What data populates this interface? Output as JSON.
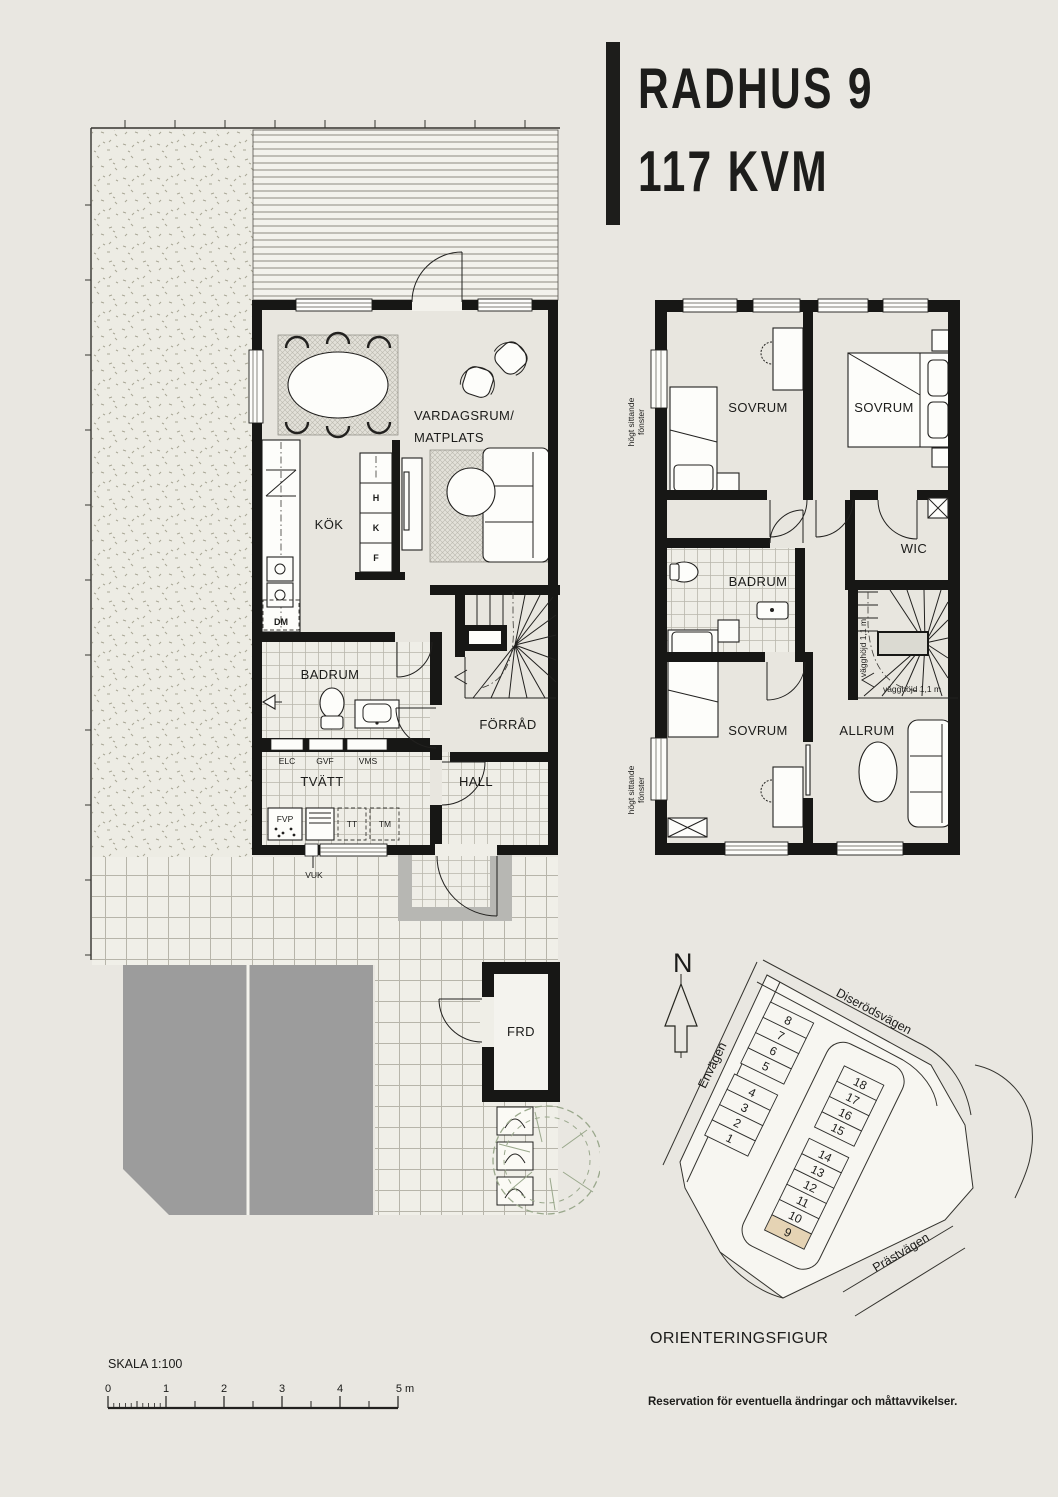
{
  "title": {
    "line1": "RADHUS 9",
    "line2": "117 KVM"
  },
  "ground_floor": {
    "living_room_line1": "VARDAGSRUM/",
    "living_room_line2": "MATPLATS",
    "kitchen": "KÖK",
    "bathroom": "BADRUM",
    "storage": "FÖRRÅD",
    "laundry": "TVÄTT",
    "hall": "HALL",
    "outdoor_storage": "FRD",
    "dishwasher": "DM",
    "cabinet_h": "H",
    "cabinet_k": "K",
    "cabinet_f": "F",
    "elc": "ELC",
    "gvf": "GVF",
    "vms": "VMS",
    "fvp": "FVP",
    "tt": "TT",
    "tm": "TM",
    "vuk": "VUK"
  },
  "upper_floor": {
    "bedroom_top_left": "SOVRUM",
    "bedroom_top_right": "SOVRUM",
    "bedroom_bottom": "SOVRUM",
    "bathroom": "BADRUM",
    "walk_in_closet": "WIC",
    "family_room": "ALLRUM",
    "high_window_line1": "högt sittande",
    "high_window_line2": "fönster",
    "wall_height_note": "vägghöjd 1,1 m"
  },
  "orientation": {
    "north_label": "N",
    "streets": {
      "west": "Envägen",
      "north": "Diserödsvägen",
      "south": "Prästvägen"
    },
    "houses": [
      "1",
      "2",
      "3",
      "4",
      "5",
      "6",
      "7",
      "8",
      "9",
      "10",
      "11",
      "12",
      "13",
      "14",
      "15",
      "16",
      "17",
      "18"
    ],
    "highlighted_house": "9",
    "caption": "ORIENTERINGSFIGUR"
  },
  "scale_bar": {
    "label": "SKALA 1:100",
    "ticks": [
      "0",
      "1",
      "2",
      "3",
      "4"
    ],
    "end_tick": "5 m"
  },
  "disclaimer": "Reservation för eventuella ändringar och måttavvikelser.",
  "colors": {
    "background": "#e9e7e1",
    "wall": "#171715",
    "floor": "#e8e6df",
    "parking_gray": "#9c9c9c",
    "porch_gray": "#b7b7b3",
    "highlight_house": "#e5d3b4",
    "tree_green": "#9aa88c"
  }
}
